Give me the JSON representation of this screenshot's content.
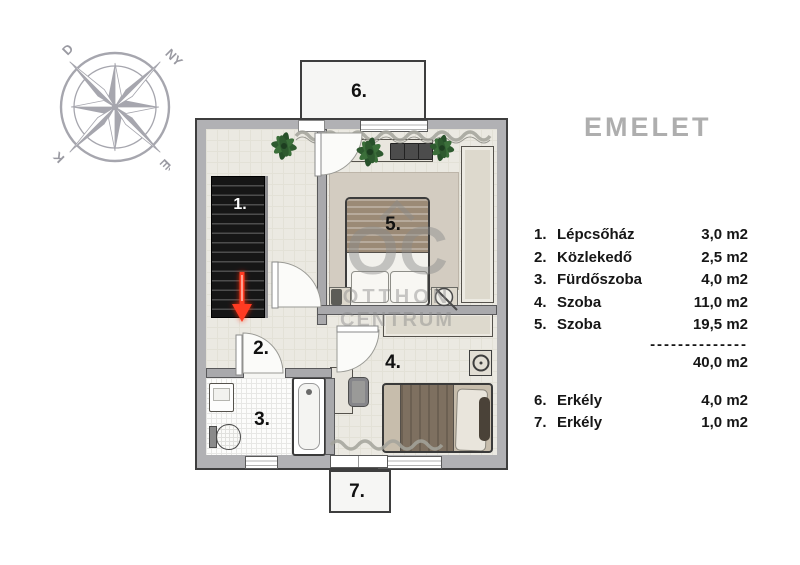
{
  "title": "EMELET",
  "compass": {
    "south": "D",
    "west": "NY",
    "east": "K",
    "north": "É"
  },
  "watermark": {
    "oc": "OC",
    "line1": "OTTHON",
    "line2": "CENTRUM"
  },
  "plan": {
    "labels": {
      "r1": "1.",
      "r2": "2.",
      "r3": "3.",
      "r4": "4.",
      "r5": "5.",
      "r6": "6.",
      "r7": "7."
    }
  },
  "legend": {
    "rooms": [
      {
        "num": "1.",
        "name": "Lépcsőház",
        "area": "3,0 m2"
      },
      {
        "num": "2.",
        "name": "Közlekedő",
        "area": "2,5 m2"
      },
      {
        "num": "3.",
        "name": "Fürdőszoba",
        "area": "4,0 m2"
      },
      {
        "num": "4.",
        "name": "Szoba",
        "area": "11,0 m2"
      },
      {
        "num": "5.",
        "name": "Szoba",
        "area": "19,5 m2"
      }
    ],
    "divider": "--------------",
    "total": "40,0 m2",
    "balconies": [
      {
        "num": "6.",
        "name": "Erkély",
        "area": "4,0 m2"
      },
      {
        "num": "7.",
        "name": "Erkély",
        "area": "1,0 m2"
      }
    ]
  },
  "colors": {
    "wall": "#b1b1b4",
    "floor": "#ebe9e2",
    "stairs": "#161616",
    "arrow_red": "#ff3a24",
    "title_gray": "#aeaeae",
    "watermark_gray": "#8a8a8a",
    "plant_green": "#2e5a2f"
  }
}
